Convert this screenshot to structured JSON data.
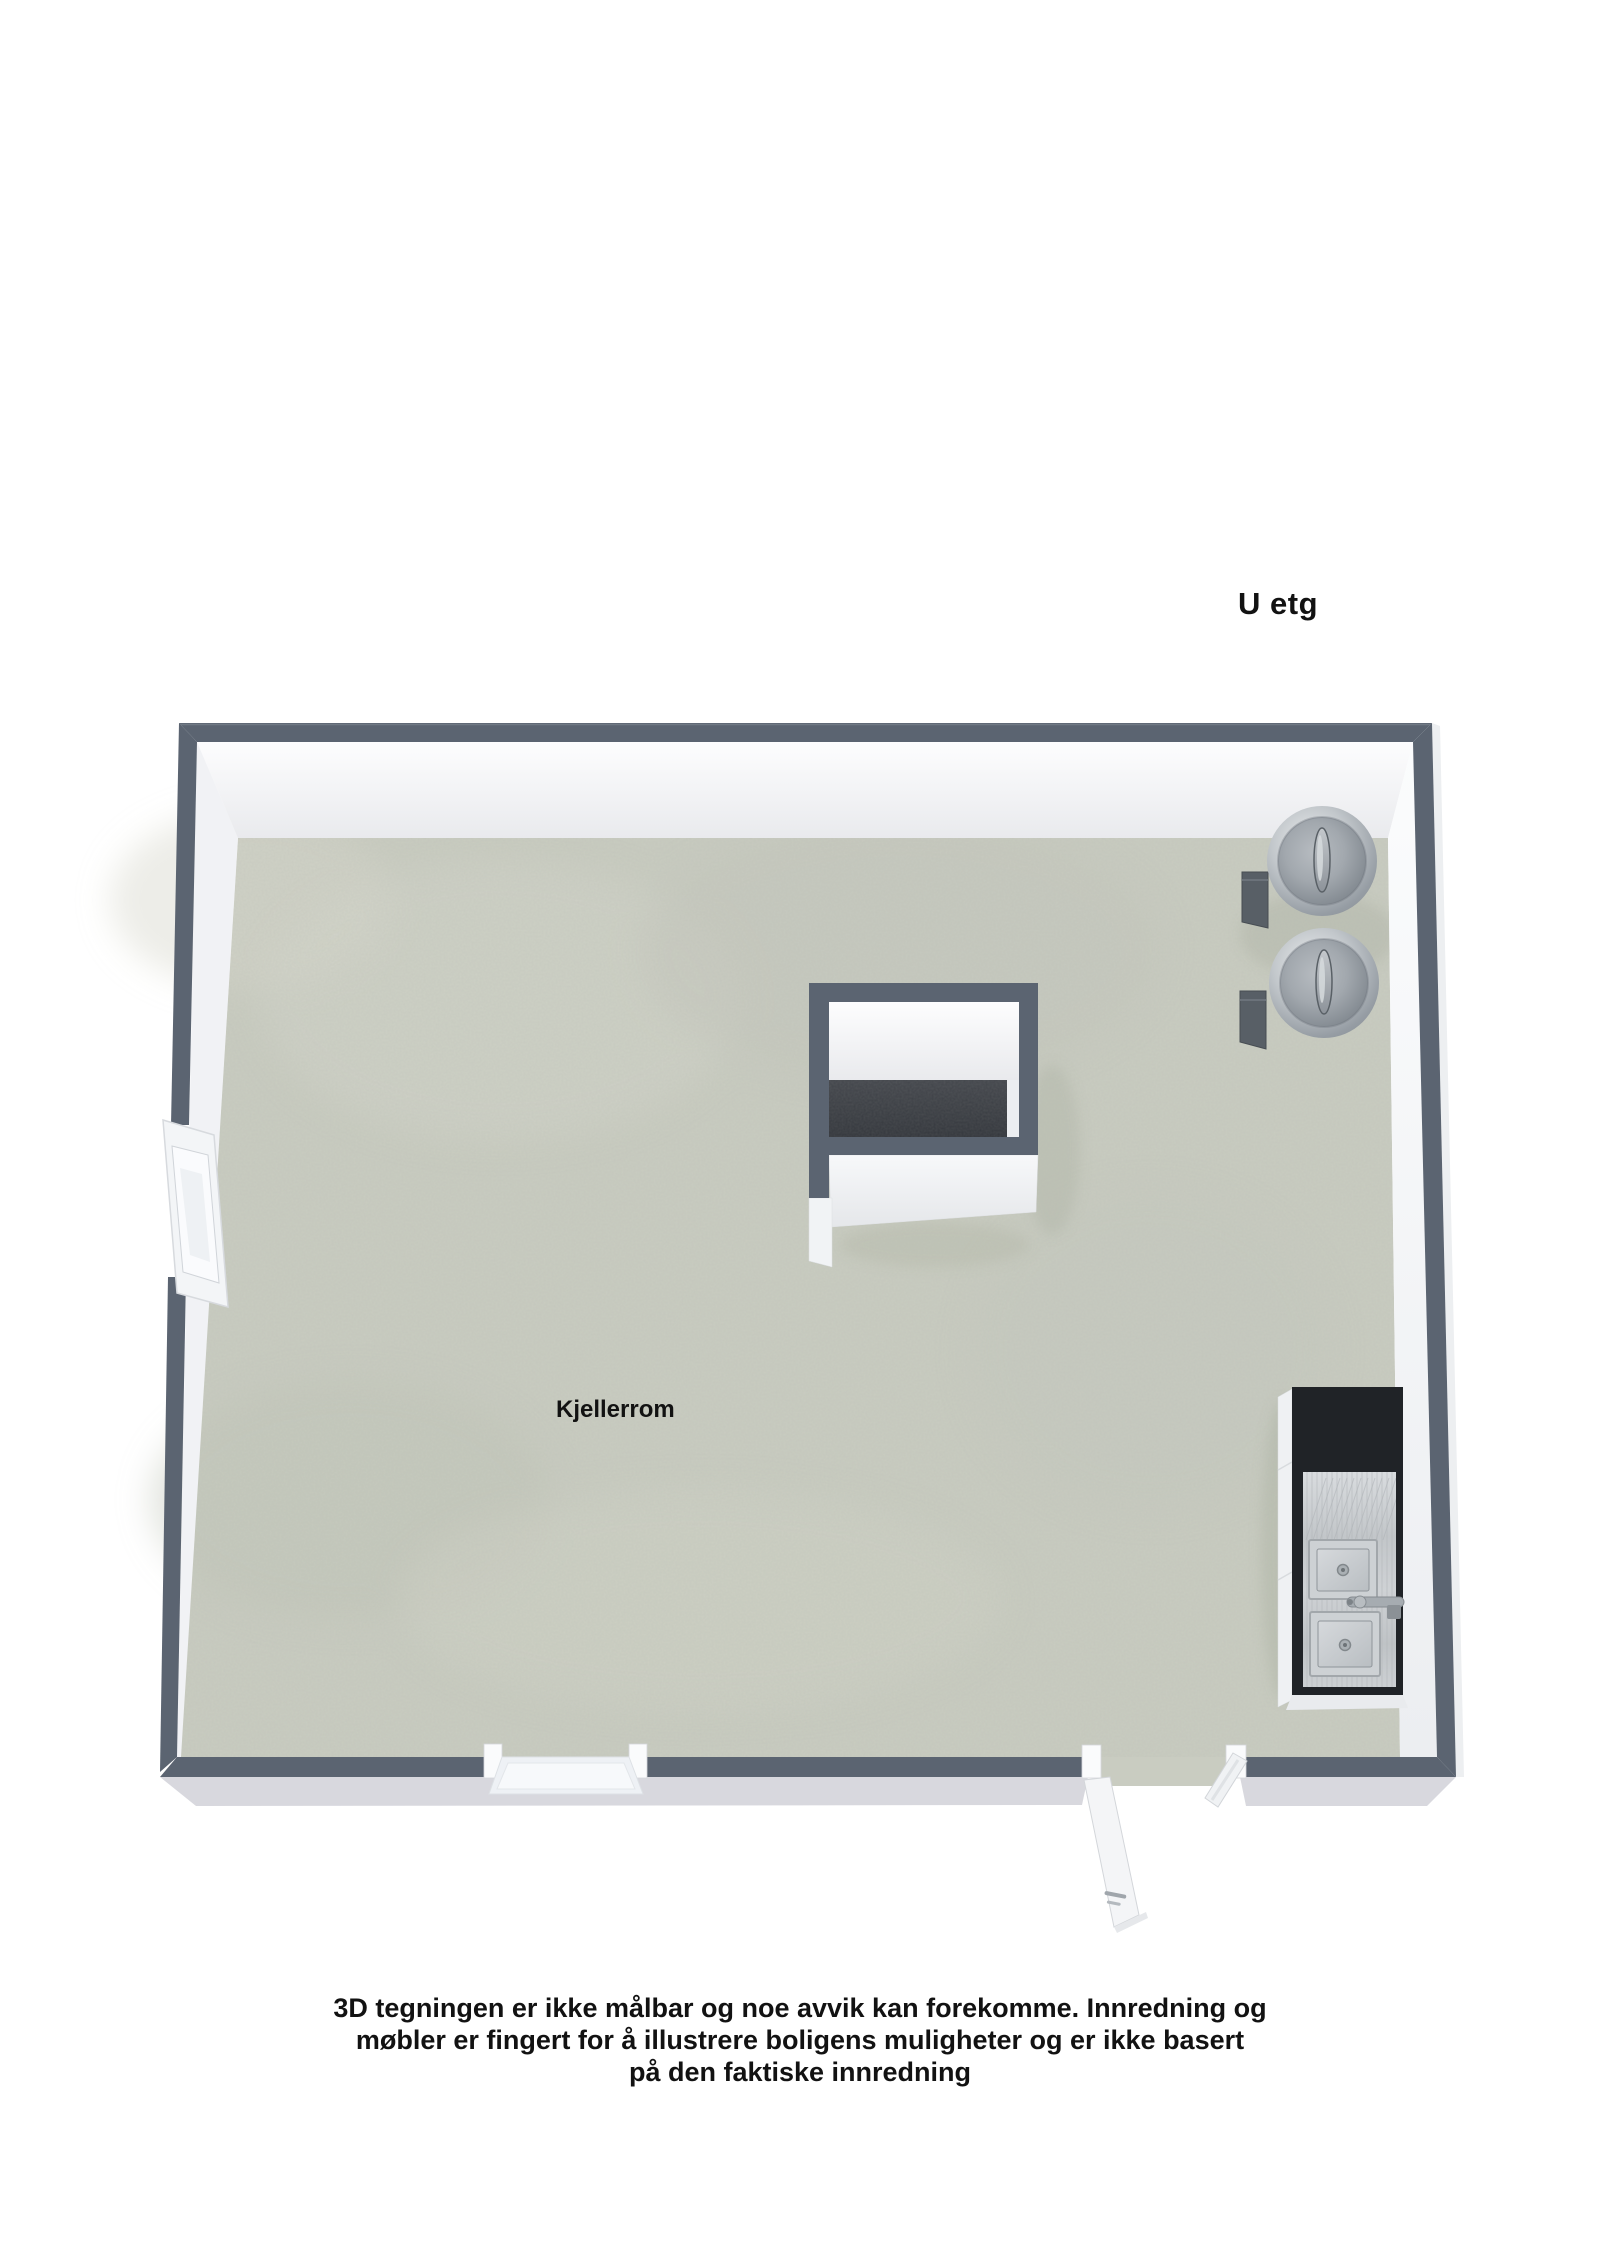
{
  "header": {
    "level_label": "U etg"
  },
  "floor_plan": {
    "room_label": "Kjellerrom",
    "colors": {
      "wall": "#5b6471",
      "floor": "#c9ccc1",
      "stair_pit": "#3a3d43",
      "counter": "#202327",
      "stainless": "#c6cacd"
    }
  },
  "disclaimer": {
    "lines": [
      "3D tegningen er ikke målbar og noe avvik kan forekomme. Innredning og",
      "møbler er fingert for å illustrere boligens muligheter og er ikke basert",
      "på den faktiske innredning"
    ]
  }
}
